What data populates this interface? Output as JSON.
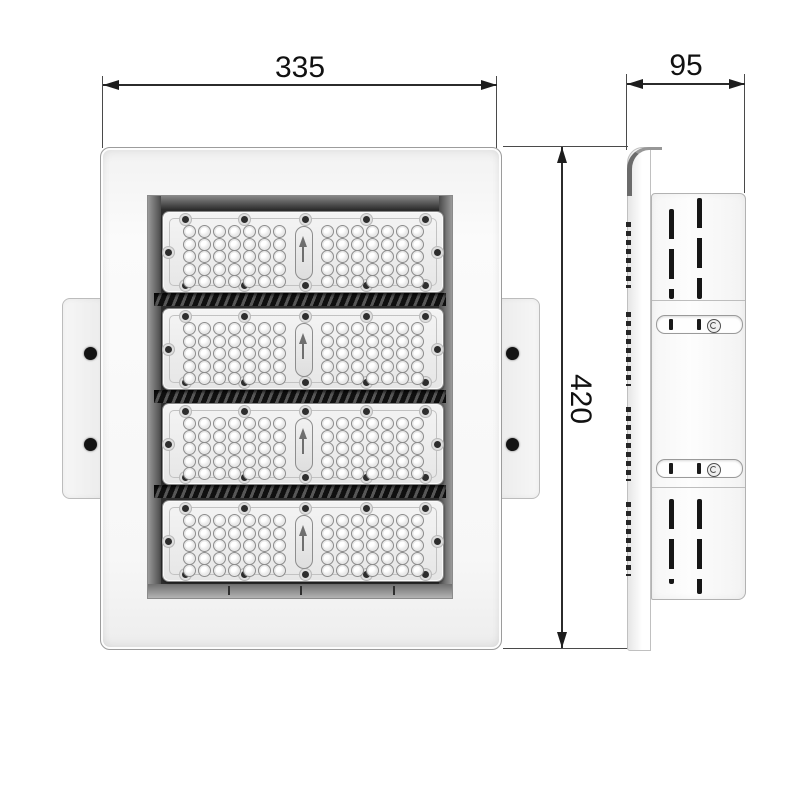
{
  "dimensions": {
    "front_width": {
      "label": "335"
    },
    "front_height": {
      "label": "420"
    },
    "side_depth": {
      "label": "95"
    }
  },
  "front_view": {
    "led_modules": {
      "count": 4,
      "led_rows": 5,
      "led_cols_per_side": 7,
      "screws_top": 5,
      "screws_bottom": 5,
      "screws_sides": 2,
      "center_arrow": "up"
    },
    "mount_tabs": {
      "count": 2,
      "holes_per_tab": 2
    },
    "heatsink_fin_bands": 3
  },
  "side_view": {
    "vent_slot_columns": 2,
    "vent_sections": 2,
    "bracket_slots": {
      "count": 2,
      "screws_per_slot": 1
    }
  },
  "colors": {
    "dimension_line": "#2b2b2b",
    "recess_dark": "#2e2e2e",
    "body_light": "#f7f7f7",
    "hole_dark": "#141414"
  }
}
